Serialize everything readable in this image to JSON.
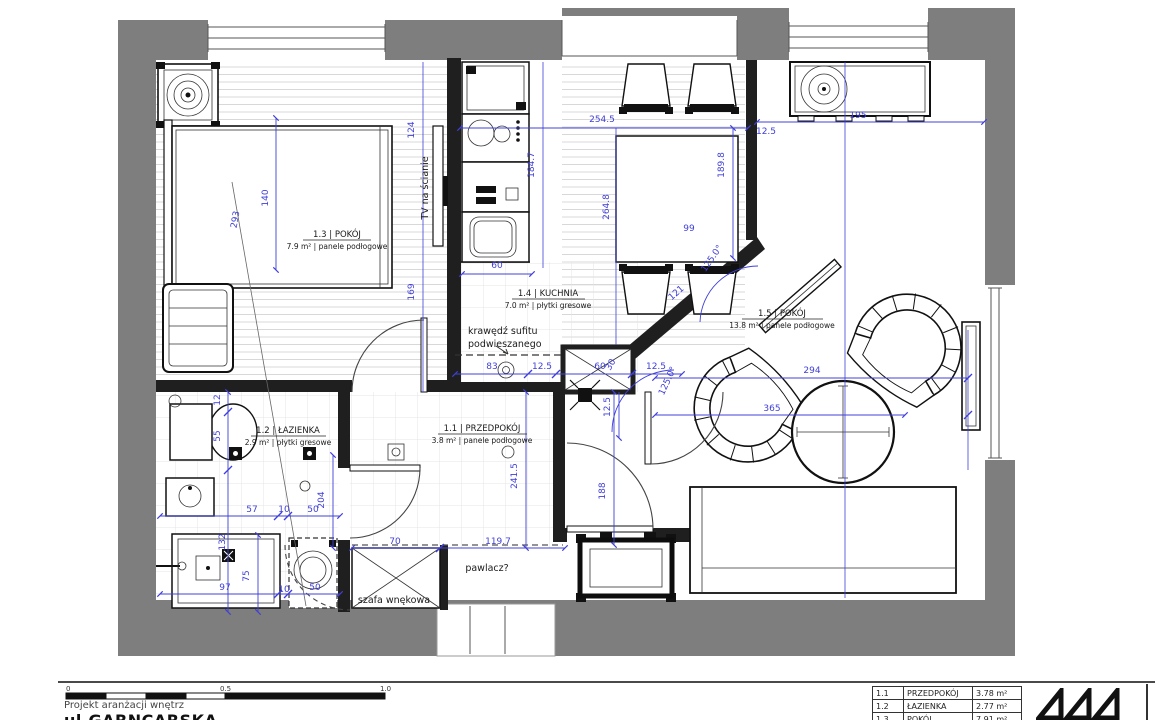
{
  "plan": {
    "rooms": {
      "r13": {
        "line1": "1.3 | POKÓJ",
        "line2": "7.9 m² | panele podłogowe"
      },
      "r14": {
        "line1": "1.4 | KUCHNIA",
        "line2": "7.0 m² | płytki gresowe"
      },
      "r15": {
        "line1": "1.5 | POKÓJ",
        "line2": "13.8 m² | panele podłogowe"
      },
      "r12": {
        "line1": "1.2 | ŁAZIENKA",
        "line2": "2.9 m² | płytki gresowe"
      },
      "r11": {
        "line1": "1.1 | PRZEDPOKÓJ",
        "line2": "3.8 m² | panele podłogowe"
      }
    },
    "annotations": {
      "tv_wall": "TV na ścianie",
      "ceiling_line1": "krawędź sufitu",
      "ceiling_line2": "podwieszanego",
      "pawlacz": "pawlacz?",
      "szafa": "szafa wnękowa"
    },
    "dims": [
      "124",
      "184.7",
      "254.5",
      "189.8",
      "264.8",
      "99",
      "12.5",
      "195",
      "140",
      "293",
      "169",
      "60",
      "83",
      "12.5",
      "60",
      "30",
      "12.5",
      "121",
      "125.0°",
      "125.0°",
      "294",
      "365",
      "12.5",
      "55",
      "12",
      "57",
      "10",
      "50",
      "204",
      "132",
      "75",
      "97",
      "10",
      "50",
      "70",
      "119.7",
      "241.5",
      "188"
    ],
    "colors": {
      "dimension_blue": "#4040d8",
      "exterior_wall": "#7e7e7e",
      "interior_wall": "#1f1f1f"
    }
  },
  "footer": {
    "scale": {
      "t0": "0",
      "t1": "0.5",
      "t2": "1.0"
    },
    "project_label": "Projekt aranżacji wnętrz",
    "street": "ul.GARNCARSKA",
    "area_table": [
      {
        "id": "1.1",
        "name": "PRZEDPOKÓJ",
        "area": "3.78 m²"
      },
      {
        "id": "1.2",
        "name": "ŁAZIENKA",
        "area": "2.77 m²"
      },
      {
        "id": "1.3",
        "name": "POKÓJ",
        "area": "7.91 m²"
      }
    ]
  }
}
